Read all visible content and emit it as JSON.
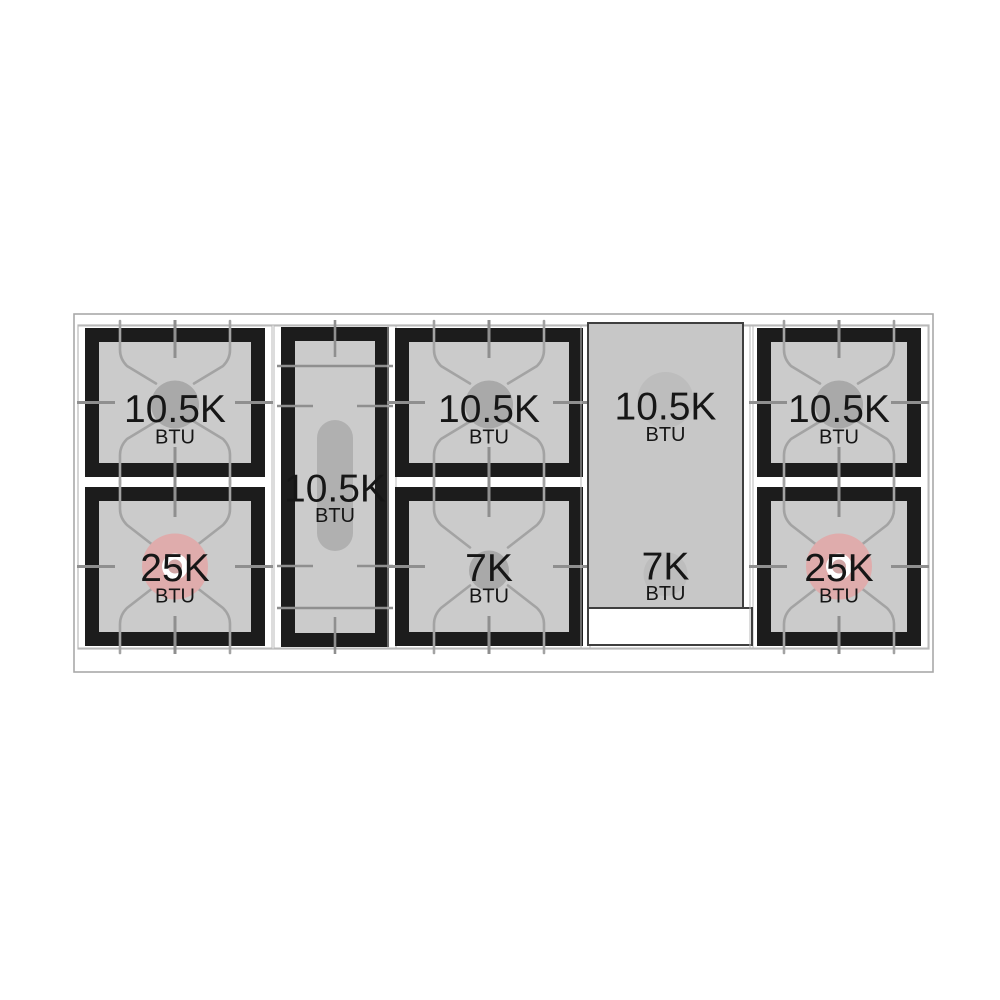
{
  "diagram": {
    "kind": "gas-cooktop-burner-layout",
    "unit_label": "BTU",
    "colors": {
      "grate_black": "#1c1c1c",
      "grate_interior_gray": "#cbcbcb",
      "griddle_gray": "#c7c7c7",
      "griddle_cap_gray": "#bdbdbd",
      "burner_cap_gray": "#a9a9a9",
      "high_power_pink": "#dfacac",
      "high_power_inner": "#d0a6a6",
      "oval_burner_gray": "#b0b0b0",
      "finger_line_gray": "#a3a3a3",
      "tick_line_gray": "#8f8f8f",
      "outline_gray": "#a9a9a9",
      "tray_line_gray": "#b9b9b9",
      "text_black": "#161616",
      "white": "#ffffff",
      "griddle_border": "#3f3f3f"
    },
    "sections": [
      {
        "id": "left-pair",
        "kind": "burner-pair",
        "burners": [
          {
            "power": "10.5K",
            "unit": "BTU",
            "type": "standard"
          },
          {
            "power": "25K",
            "unit": "BTU",
            "type": "high-power"
          }
        ]
      },
      {
        "id": "center-oval",
        "kind": "oval-burner",
        "burners": [
          {
            "power": "10.5K",
            "unit": "BTU",
            "type": "oval"
          }
        ]
      },
      {
        "id": "middle-pair",
        "kind": "burner-pair",
        "burners": [
          {
            "power": "10.5K",
            "unit": "BTU",
            "type": "standard"
          },
          {
            "power": "7K",
            "unit": "BTU",
            "type": "simmer"
          }
        ]
      },
      {
        "id": "griddle",
        "kind": "griddle-zone",
        "burners": [
          {
            "power": "10.5K",
            "unit": "BTU",
            "type": "under-griddle"
          },
          {
            "power": "7K",
            "unit": "BTU",
            "type": "under-griddle"
          }
        ]
      },
      {
        "id": "right-pair",
        "kind": "burner-pair",
        "burners": [
          {
            "power": "10.5K",
            "unit": "BTU",
            "type": "standard"
          },
          {
            "power": "25K",
            "unit": "BTU",
            "type": "high-power"
          }
        ]
      }
    ]
  }
}
